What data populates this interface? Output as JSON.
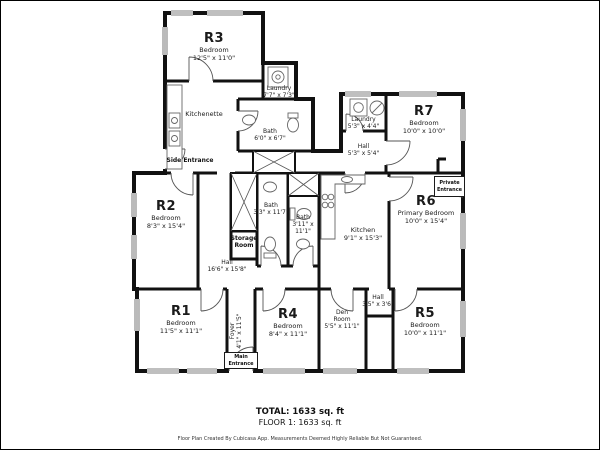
{
  "rooms": {
    "r3": {
      "code": "R3",
      "type": "Bedroom",
      "dims": "12'5\" x 11'0\""
    },
    "laundry_top": {
      "type": "Laundry",
      "dims": "7'7\" x 7'3\""
    },
    "kitchenette": {
      "type": "Kitchenette"
    },
    "bath_top": {
      "type": "Bath",
      "dims": "6'0\" x 6'7\""
    },
    "side_entrance": {
      "label": "Side Entrance"
    },
    "r2": {
      "code": "R2",
      "type": "Bedroom",
      "dims": "8'3\" x 15'4\""
    },
    "storage": {
      "label": "Storage Room"
    },
    "hall_main": {
      "type": "Hall",
      "dims": "16'6\" x 15'8\""
    },
    "bath_a": {
      "type": "Bath",
      "dims": "3'3\" x 11'7\""
    },
    "bath_b": {
      "type": "Bath",
      "dims": "3'11\" x 11'1\""
    },
    "kitchen": {
      "type": "Kitchen",
      "dims": "9'1\" x 15'3\""
    },
    "laundry2": {
      "type": "Laundry",
      "dims": "5'3\" x 4'4\""
    },
    "hall2": {
      "type": "Hall",
      "dims": "5'3\" x 5'4\""
    },
    "r7": {
      "code": "R7",
      "type": "Bedroom",
      "dims": "10'0\" x 10'0\""
    },
    "private_entrance": {
      "label": "Private Entrance"
    },
    "r6": {
      "code": "R6",
      "type": "Primary Bedroom",
      "dims": "10'0\" x 15'4\""
    },
    "r1": {
      "code": "R1",
      "type": "Bedroom",
      "dims": "11'5\" x 11'1\""
    },
    "foyer": {
      "type": "Foyer",
      "dims": "4'1\" x 11'5\""
    },
    "main_entrance": {
      "label": "Main Entrance"
    },
    "r4": {
      "code": "R4",
      "type": "Bedroom",
      "dims": "8'4\" x 11'1\""
    },
    "den": {
      "type": "Den Room",
      "dims": "5'5\" x 11'1\""
    },
    "hall3": {
      "type": "Hall",
      "dims": "3'5\" x 3'6\""
    },
    "r5": {
      "code": "R5",
      "type": "Bedroom",
      "dims": "10'0\" x 11'1\""
    }
  },
  "footer": {
    "total": "TOTAL: 1633 sq. ft",
    "floor": "FLOOR 1: 1633 sq. ft",
    "disclaimer": "Floor Plan Created By Cubicasa App. Measurements Deemed Highly Reliable But Not Guaranteed."
  },
  "colors": {
    "wall": "#111111",
    "fixture": "#666666",
    "text": "#1b1b1b",
    "background": "#ffffff"
  }
}
